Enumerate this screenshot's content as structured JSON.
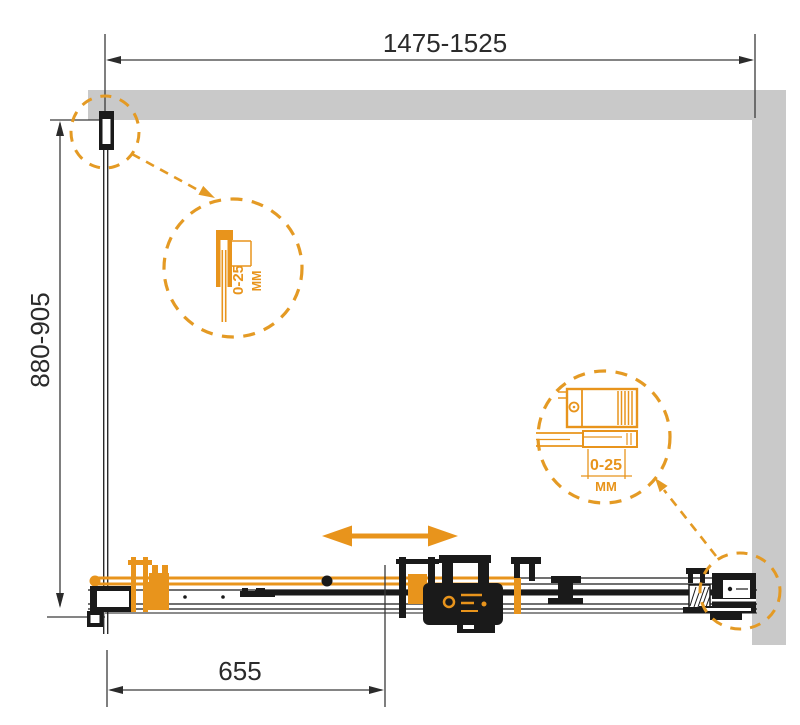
{
  "diagram": {
    "type": "shower-enclosure-installation-drawing",
    "dimensions": {
      "width_top": "1475-1525",
      "height_left": "880-905",
      "door_bottom": "655"
    },
    "details": {
      "wall_profile": {
        "range": "0-25",
        "unit": "ММ"
      },
      "wall_bracket": {
        "range": "0-25",
        "unit": "ММ"
      }
    },
    "colors": {
      "accent_orange": "#E8941C",
      "dashed_circle_orange": "#E49A24",
      "wall_gray": "#C9C9C9",
      "ink_black": "#1A1A1A",
      "dimension_line": "#3a3a3a"
    }
  }
}
